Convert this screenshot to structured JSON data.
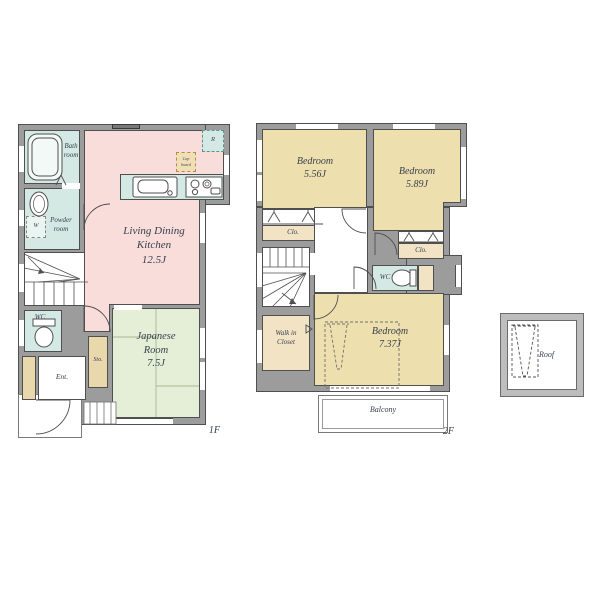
{
  "f1": {
    "floor_label": "1F",
    "bath": [
      "Bath",
      "room"
    ],
    "powder": [
      "Powder",
      "room"
    ],
    "washer": "W",
    "wc": "WC",
    "ent": "Ent.",
    "sto": "Sto.",
    "japanese": [
      "Japanese",
      "Room",
      "7.5J"
    ],
    "ldk": [
      "Living Dining",
      "Kitchen",
      "12.5J"
    ],
    "fridge": "R",
    "cupboard": [
      "Cup",
      "board"
    ]
  },
  "f2": {
    "floor_label": "2F",
    "bedroom1": [
      "Bedroom",
      "5.56J"
    ],
    "bedroom2": [
      "Bedroom",
      "5.89J"
    ],
    "closet1": "Clo.",
    "closet2": "Clo.",
    "wc": "WC",
    "wic": [
      "Walk in",
      "Closet"
    ],
    "bedroom3": [
      "Bedroom",
      "7.37J"
    ],
    "balcony": "Balcony"
  },
  "roof": {
    "label": "Roof"
  },
  "colors": {
    "ldk_pink": "#f8dddb",
    "wet_area_teal": "#d4e9e3",
    "tatami_green": "#e5efd8",
    "bedroom_tan": "#eee0ae",
    "closet_tan": "#f1e3c3",
    "storage_tan": "#ead8ad",
    "wall_gray": "#9c9c9c",
    "line_dark": "#4f4f4f",
    "text": "#39404e"
  }
}
